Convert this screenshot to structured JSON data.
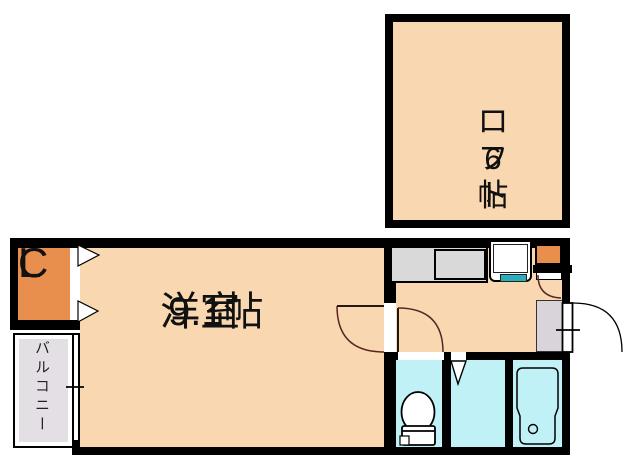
{
  "plan": {
    "loft": {
      "name": "ロフト",
      "size": "6帖"
    },
    "western_room": {
      "name": "洋室",
      "size": "9.1帖"
    },
    "closet": {
      "letter1": "C",
      "letter2": "L"
    },
    "balcony": {
      "name": "バルコニー"
    }
  },
  "colors": {
    "wall": "#000000",
    "peach": "#f9d8b1",
    "orange": "#e98f4e",
    "cyan": "#bff1f7",
    "balconygray": "#e4dfe4",
    "entrygray": "#d9d4d9",
    "countergray": "#d9d9d9",
    "teal": "#29aebc",
    "maroon": "#5a2424"
  }
}
